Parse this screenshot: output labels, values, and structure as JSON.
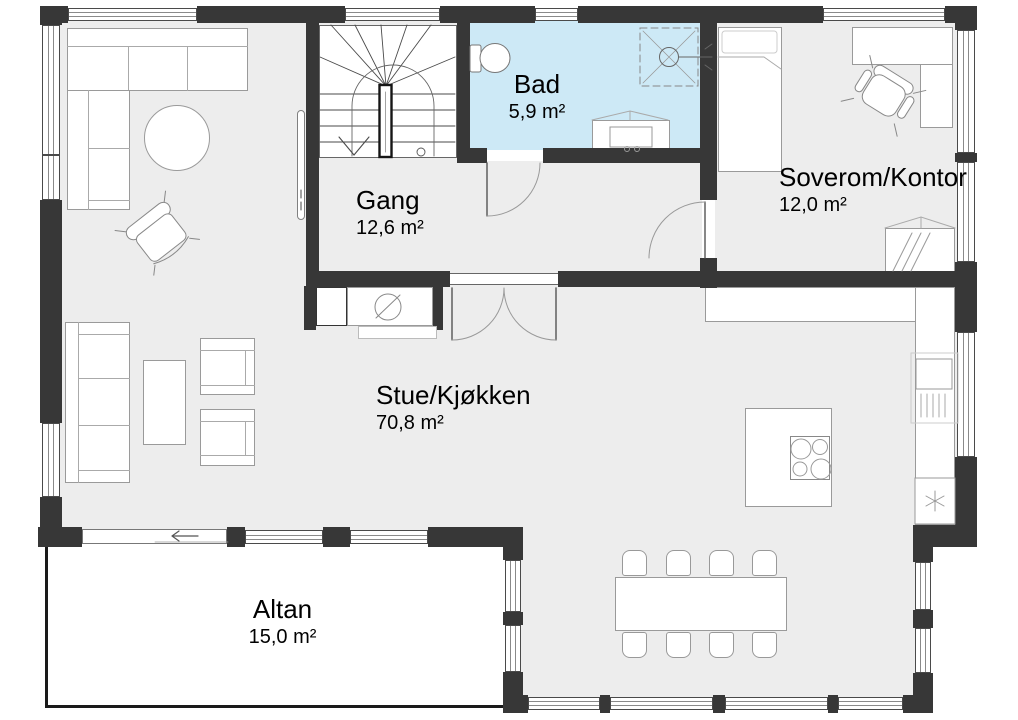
{
  "title": "Floor plan",
  "colors": {
    "wall": "#373737",
    "floor": "#ededed",
    "bathroom": "#cde9f6",
    "altan_border": "#1a1a1a"
  },
  "rooms": {
    "bad": {
      "name": "Bad",
      "area": "5,9 m²"
    },
    "gang": {
      "name": "Gang",
      "area": "12,6 m²"
    },
    "soverom": {
      "name": "Soverom/Kontor",
      "area": "12,0 m²"
    },
    "stue": {
      "name": "Stue/Kjøkken",
      "area": "70,8 m²"
    },
    "altan": {
      "name": "Altan",
      "area": "15,0 m²"
    }
  }
}
